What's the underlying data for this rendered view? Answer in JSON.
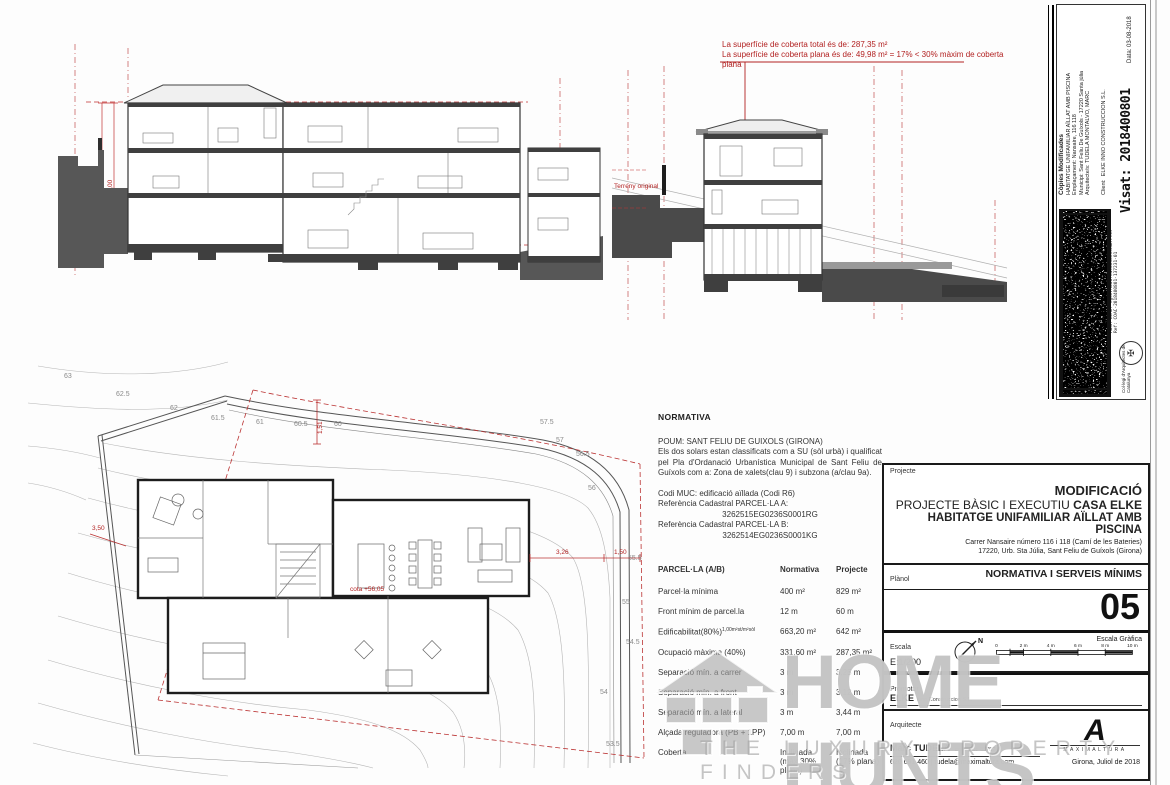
{
  "annotations": {
    "coberta_line1": "La superfície de coberta total és de: 287,35  m²",
    "coberta_line2": "La superfície de coberta plana és de: 49,98  m² = 17% < 30% màxim de coberta plana",
    "arm": "ARM:7,00",
    "am": "AM:7,00",
    "terreny": "Terreny original"
  },
  "site_plan": {
    "contours": [
      "63",
      "62.5",
      "62",
      "61.5",
      "61",
      "60.5",
      "60",
      "57.5",
      "57",
      "56.5",
      "56",
      "55.5",
      "55",
      "54.5",
      "54",
      "53.5"
    ],
    "dims": {
      "left": "3,50",
      "top": "1,51",
      "right_a": "3,26",
      "right_b": "1,50"
    },
    "cota": "cota +56,05"
  },
  "normativa": {
    "heading": "NORMATIVA",
    "p1": "POUM: SANT FELIU DE GUIXOLS (GIRONA)",
    "p2": "Els dos solars estan classificats com a SU (sòl urbà) i qualificat pel Pla d'Ordanació Urbanística Municipal de Sant Feliu de Guíxols com a: Zona de xalets(clau 9) i subzona (a/clau 9a).",
    "p3": "Codi MUC: edificació aïllada  (Codi R6)",
    "ref_a_label": "Referència Cadastral PARCEL·LA A:",
    "ref_a_value": "3262515EG0236S0001RG",
    "ref_b_label": "Referència Cadastral PARCEL·LA B:",
    "ref_b_value": "3262514EG0236S0001KG"
  },
  "table": {
    "headers": [
      "PARCEL·LA (A/B)",
      "Normativa",
      "Projecte"
    ],
    "rows": [
      {
        "label": "Parcel·la mínima",
        "note": "",
        "norm": "400 m²",
        "norm2": "",
        "proj": "829 m²",
        "proj2": ""
      },
      {
        "label": "Front mínim de parcel.la",
        "note": "",
        "norm": "12 m",
        "norm2": "",
        "proj": "60 m",
        "proj2": ""
      },
      {
        "label": "Edificabilitat(80%)",
        "note": "1,00m²st/m²sòl",
        "norm": "663,20 m²",
        "norm2": "",
        "proj": "642 m²",
        "proj2": ""
      },
      {
        "label": "Ocupació màxima (40%)",
        "note": "",
        "norm": "331,60 m²",
        "norm2": "",
        "proj": "287,35 m²",
        "proj2": ""
      },
      {
        "label": "Separació mín. a carrer",
        "note": "",
        "norm": "3 m",
        "norm2": "",
        "proj": "3,25 m",
        "proj2": ""
      },
      {
        "label": "Separació mín. a front",
        "note": "",
        "norm": "3 m",
        "norm2": "",
        "proj": "3,12 m",
        "proj2": ""
      },
      {
        "label": "Separació mín. a lateral",
        "note": "",
        "norm": "3 m",
        "norm2": "",
        "proj": "3,44 m",
        "proj2": ""
      },
      {
        "label": "Alçada reguladora (PB + 1PP)",
        "note": "",
        "norm": "7,00 m",
        "norm2": "",
        "proj": "7,00 m",
        "proj2": ""
      },
      {
        "label": "Coberta",
        "note": "",
        "norm": "Inclinada",
        "norm2": "(màx 30% plana)",
        "proj": "Inclinada",
        "proj2": "(17% plana)"
      }
    ]
  },
  "title_block": {
    "projecte_label": "Projecte",
    "title1": "MODIFICACIÓ",
    "title2a": "PROJECTE BÀSIC I EXECUTIU ",
    "title2b": "CASA ELKE",
    "title3": "HABITATGE UNIFAMILIAR AÏLLAT AMB PISCINA",
    "address1": "Carrer Nansaire número 116 i 118 (Camí de les Bateries)",
    "address2": "17220, Urb. Sta Júlia, Sant Feliu de Guíxols (Girona)",
    "planol_label": "Plànol",
    "planol_value": "NORMATIVA I SERVEIS MÍNIMS",
    "sheet_number": "05",
    "escala_label": "Escala",
    "escala_value": "E:1/200",
    "escala_grafica_label": "Escala Gràfica",
    "scale_ticks": [
      "0",
      "2 m",
      "4 m",
      "6 m",
      "8 m",
      "10 m"
    ],
    "north_label": "N",
    "promotor_label": "Promotor",
    "promotor_name": "ELKE",
    "promotor_suffix": "Inno Construccion S.L.",
    "arquitecte_label": "Arquitecte",
    "arquitecte_name": "Marc TUDELA",
    "colegiat": "col·legiat: 63752-1",
    "contact": "620 691 460 | tudela@maximaltura.com",
    "logo_letter": "A",
    "logo_name": "MAXIMALTURA",
    "date": "Girona, Juliol de 2018"
  },
  "visat_strip": {
    "header": "Còpies Modificades",
    "line1": "HABITATGE UNIFAMILIAR AÏLLAT AMB PISCINA",
    "line2": "Emplaçament: Nansaire, 116 118",
    "line3": "Municipi: Sant Feliu De Guíxols - 17220 Santa júlia",
    "line4": "Arquitecte/s: TUDELA MONTALVO, MARC",
    "client_label": "Client:",
    "client_value": "ELKE INNO CONSTRUCCION S.L.",
    "data": "Data: 03-08-2018",
    "visat": "Visat: 2018400801",
    "hash1": "Hash: 5O5lOa=4gTfYzEqbAu4c4LCD=",
    "hash2": "Hash COAC: #gezrAUdBfeNcU83O65=KaRlfAk",
    "ref": "Ref: COAC-2018400801-137231-01",
    "coac": "Col·legi d'Arquitectes de Catalunya",
    "seal_glyph": "✠"
  },
  "watermark": {
    "name": "HOME HUNTS",
    "tagline": "THE LUXURY PROPERTY FINDERS"
  },
  "colors": {
    "red": "#b22222",
    "terrain": "#4f4f4f",
    "slab": "#3f3f3f"
  }
}
